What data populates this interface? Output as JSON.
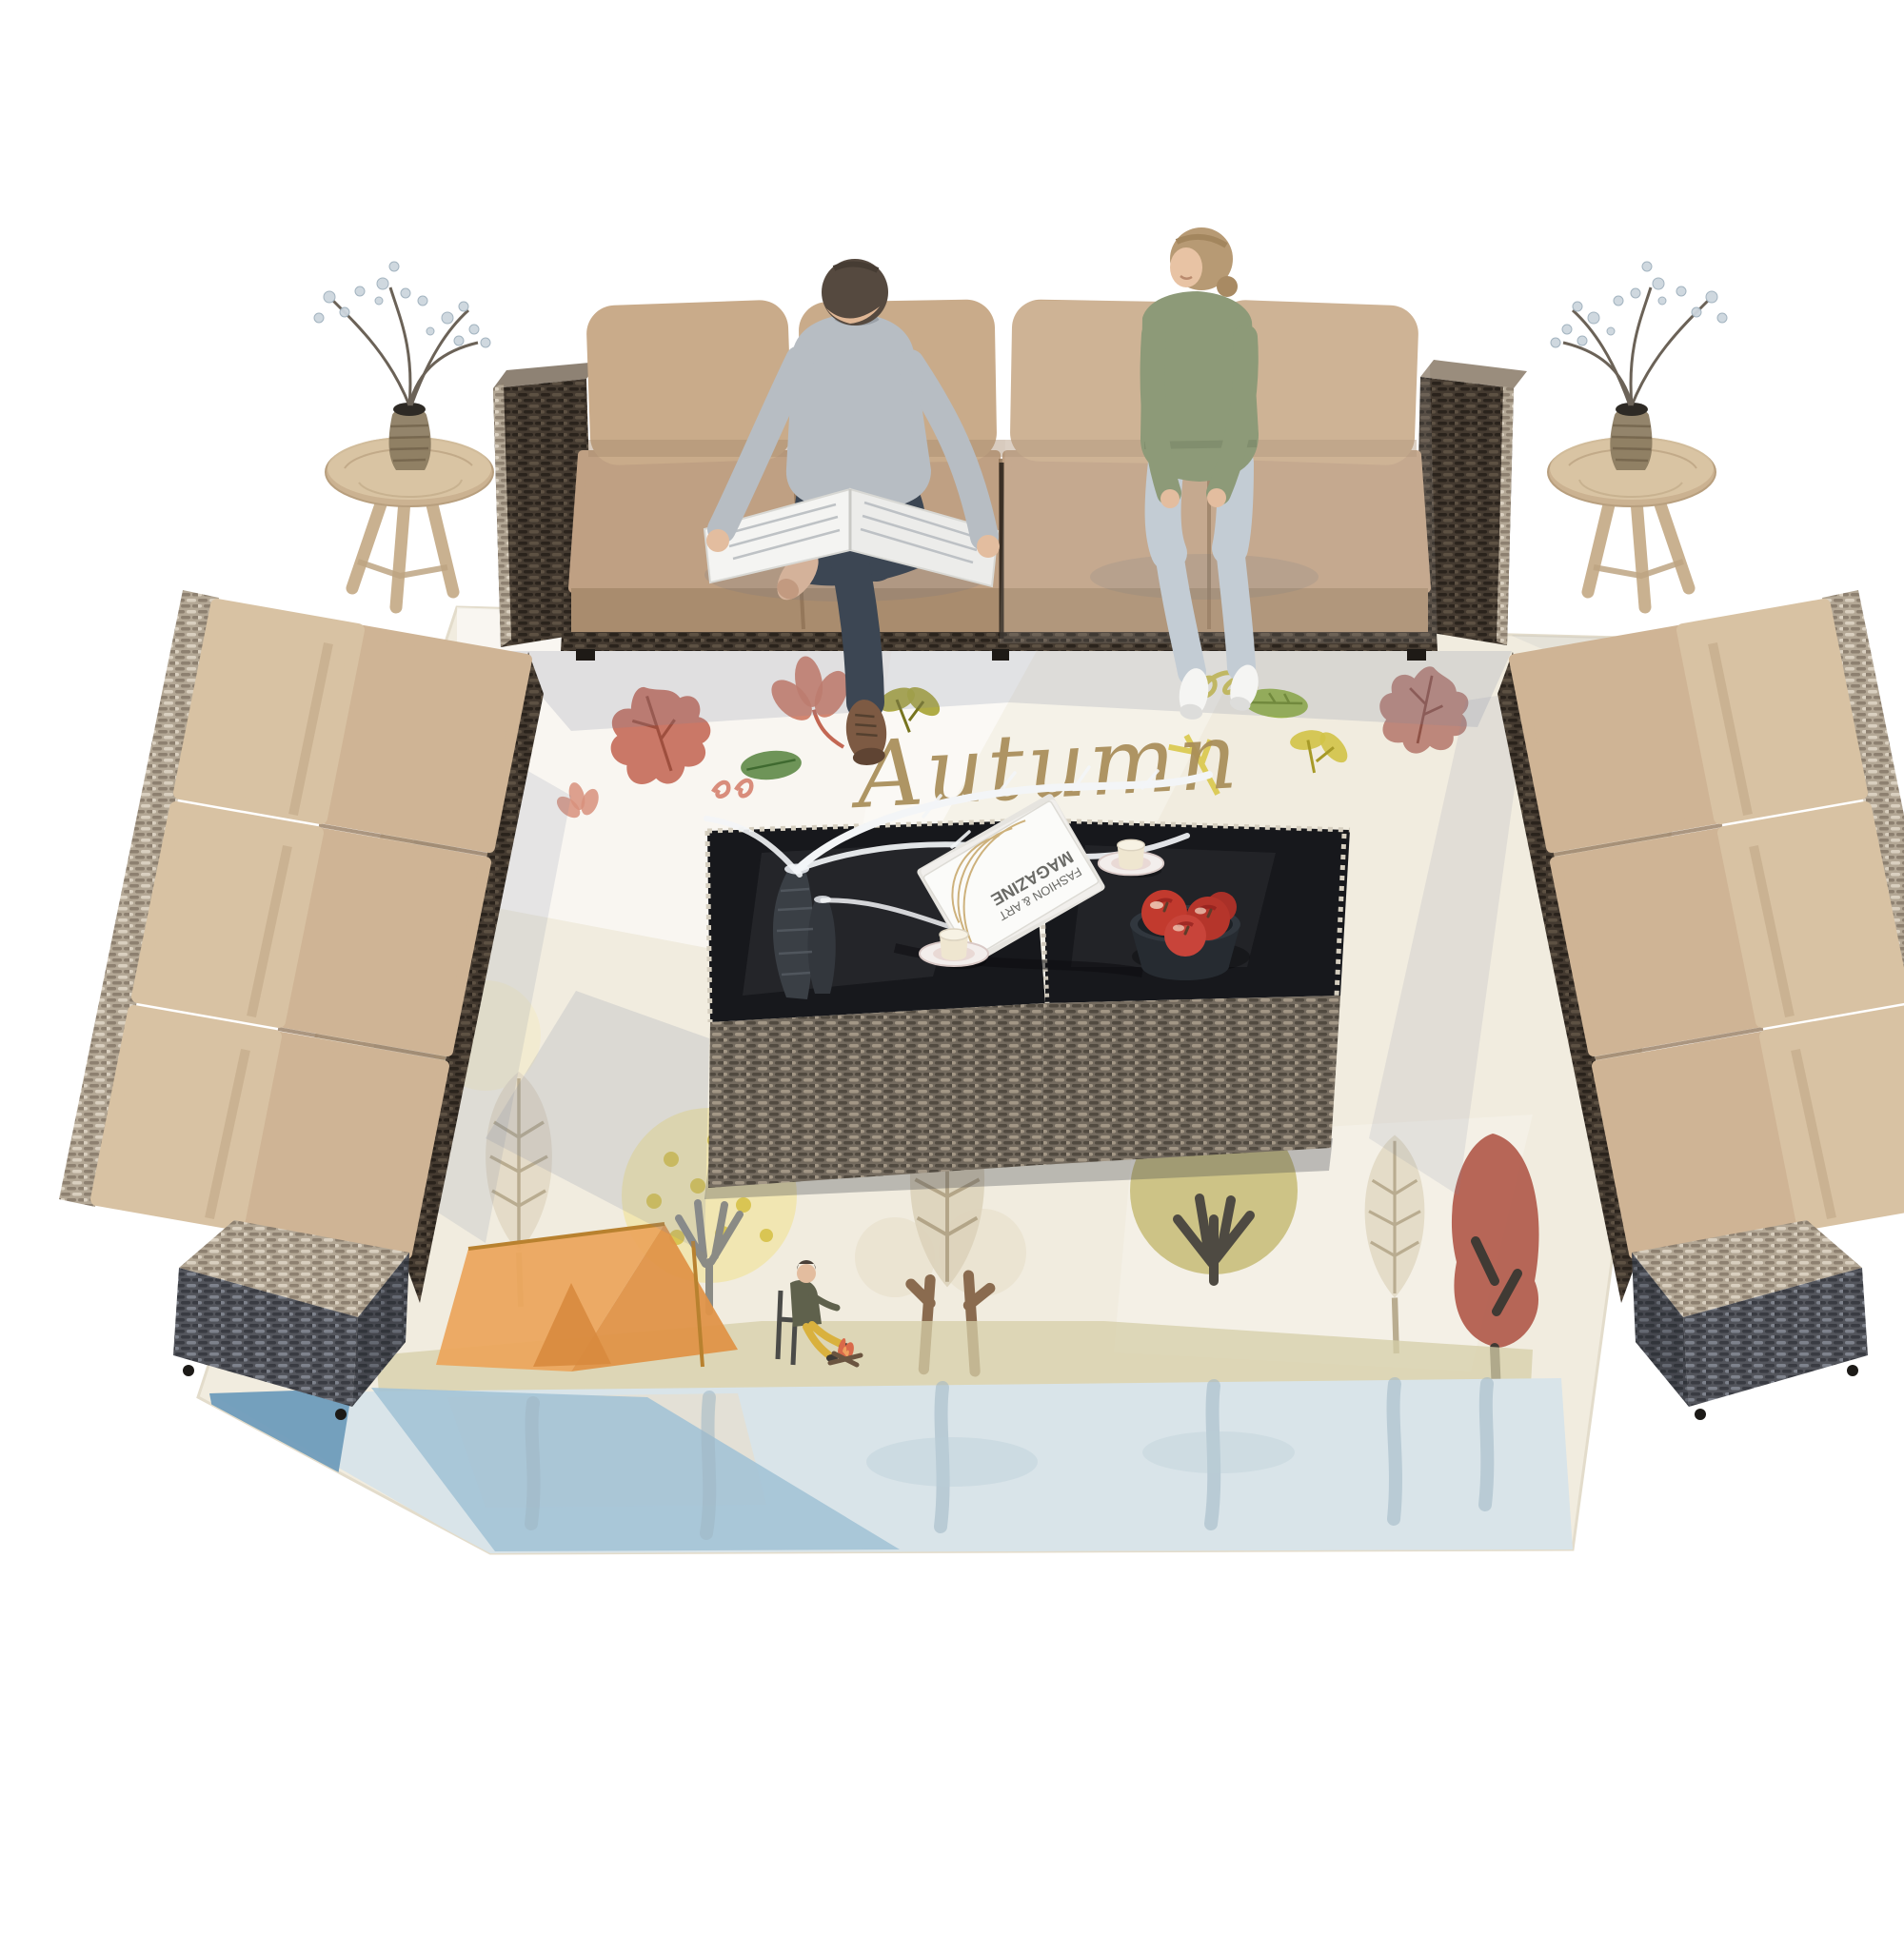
{
  "meta": {
    "description": "Top-down product render of a 12-piece outdoor rattan patio conversation set: a long 4-seat sofa at top with a man reading a newspaper and a smiling woman seated on it, two angled 3-seat sofas on left and right, two wicker coffee tables with black glass tops in the center, two rustic wooden stool side-tables with vases of silvery branches, all arranged on a large autumn-illustrated area rug with trees, a tent, a camper by a campfire and a lake."
  },
  "rug": {
    "script_text": "Autumn",
    "motifs": [
      "red oak leaves",
      "coral flower",
      "green leaves",
      "olive sprigs",
      "yellow squiggles",
      "beige chevron-leaf trees",
      "yellow dotted tree",
      "olive tree",
      "red tree",
      "orange tent",
      "camper on chair by campfire",
      "blue lake with reflections"
    ]
  },
  "magazine": {
    "line1": "FASHION & ART",
    "line2": "MAGAZINE"
  },
  "furniture": {
    "top_sofa": "4-seat wicker sofa, espresso rattan, tan cushions, arm cubes both ends",
    "left_sofa": "3-seat armless wicker sofa angled along left side, arm cube at lower end",
    "right_sofa": "3-seat armless wicker sofa angled along right side, arm cube at lower end",
    "coffee_tables": "two rattan cube coffee tables with black tempered glass tops",
    "stools": "two round rustic wood stool side tables with glass vases of round-leaf branches"
  },
  "props": {
    "table_items": [
      "two hammered dark vases with white frosted branches",
      "stack of white magazines",
      "two cream cups on saucers",
      "dark bowl with red apples"
    ],
    "man": "gray sweater, dark jeans, brown boot, reading open newspaper, legs crossed",
    "woman": "sage green sweatshirt, light jeans, white sneakers, hair pulled back, smiling toward man"
  },
  "palette": {
    "cushionTan": "#c9ab8a",
    "cushionLight": "#d8c2a3",
    "cushionShadow": "#a98c6e",
    "wickerDark": "#443a30",
    "wickerLight": "#b3a795",
    "wickerCool": "#53555c",
    "wickerTable": "#746b5f",
    "wood": "#cbb291",
    "glassBlack": "#17181c",
    "rugCream": "#f1ecdf",
    "scriptTan": "#a88d58",
    "leafRed": "#c36753",
    "leafGreen": "#5e8a47",
    "leafOlive": "#a8a435",
    "leafYellow": "#d9c84a",
    "tentOrange": "#eba65e",
    "treeBeige": "#e3dac6",
    "treeOlive": "#c9bf7e",
    "treeRed": "#b15a4b",
    "waterPale": "#d9e4e9",
    "waterBlue": "#a3c3d6",
    "waterDeep": "#6f9cba",
    "appleRed": "#c23a2e",
    "sweaterGray": "#b7bdc3",
    "sweaterGreen": "#8d9a78",
    "jeansDark": "#3c4653",
    "jeansLight": "#c3ccd4",
    "skin": "#e3bd9f",
    "shadowBlue": "#7c87a0"
  }
}
